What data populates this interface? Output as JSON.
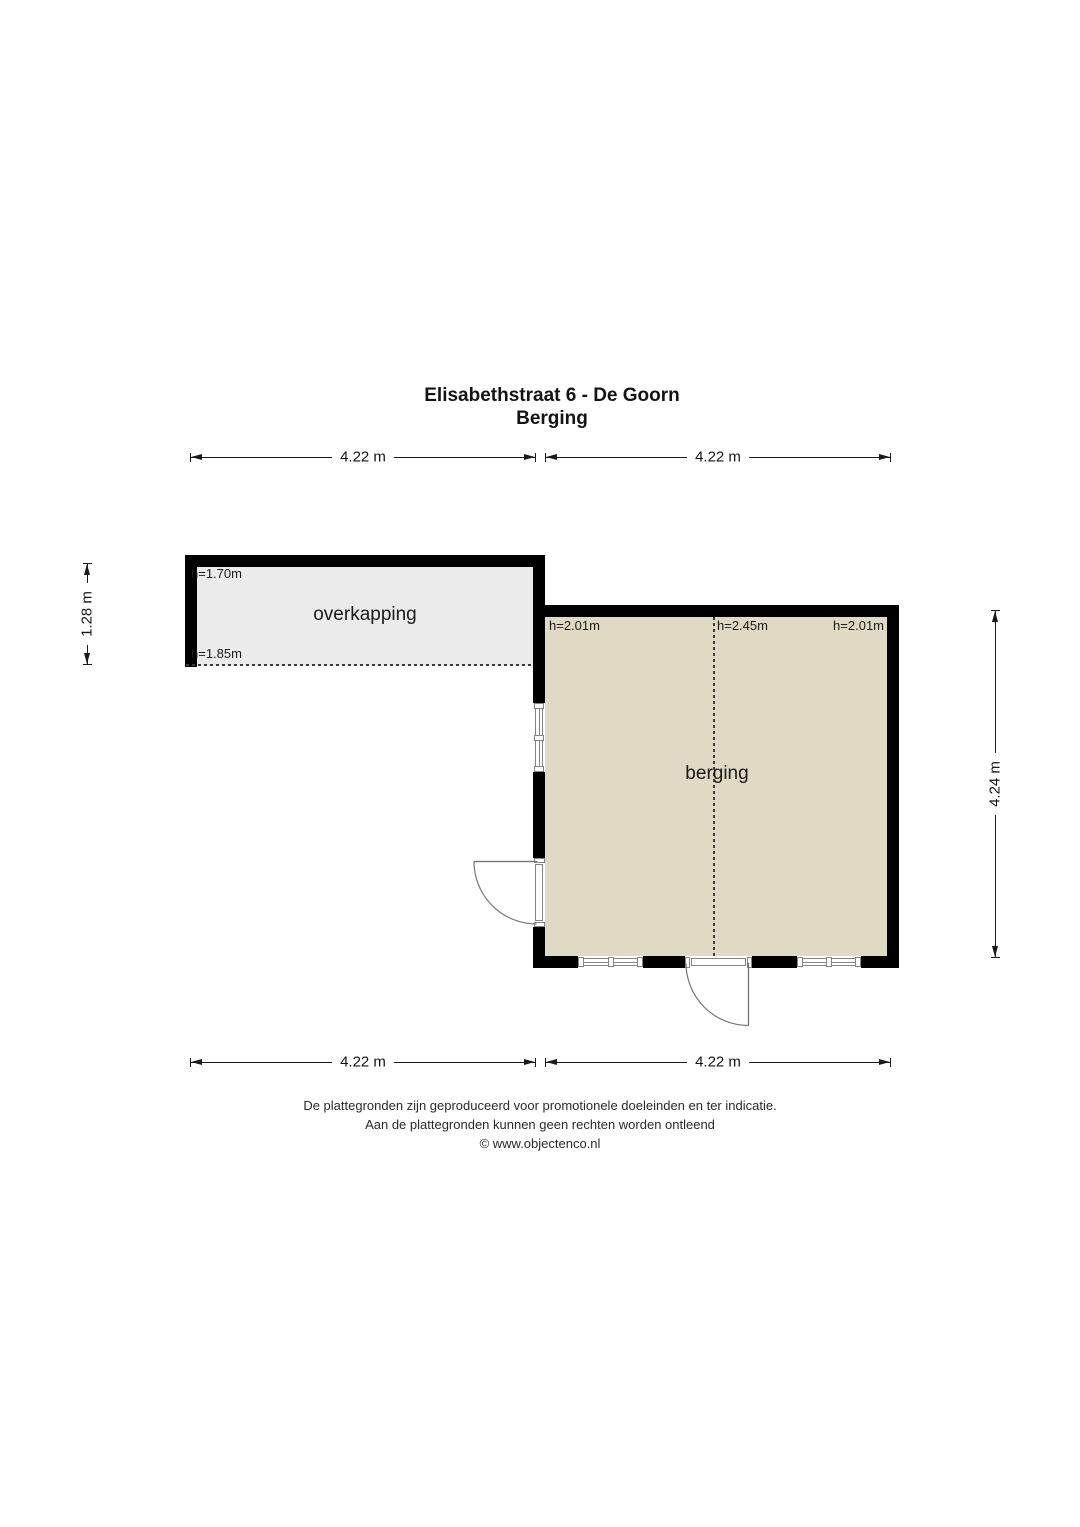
{
  "title": {
    "line1": "Elisabethstraat 6 - De Goorn",
    "line2": "Berging"
  },
  "dimensions": {
    "top_left": "4.22 m",
    "top_right": "4.22 m",
    "bottom_left": "4.22 m",
    "bottom_right": "4.22 m",
    "left": "1.28 m",
    "right": "4.24 m"
  },
  "rooms": {
    "overkapping": {
      "name": "overkapping",
      "height_top": "h=1.70m",
      "height_bottom": "h=1.85m"
    },
    "berging": {
      "name": "berging",
      "height_left": "h=2.01m",
      "height_center": "h=2.45m",
      "height_right": "h=2.01m"
    }
  },
  "footer": {
    "line1": "De plattegronden zijn geproduceerd voor promotionele doeleinden en ter indicatie.",
    "line2": "Aan de plattegronden kunnen geen rechten worden ontleend",
    "line3": "© www.objectenco.nl"
  },
  "colors": {
    "wall": "#000000",
    "berging_fill": "#e0d9c3",
    "overkapping_fill": "#ebebeb",
    "line": "#1a1a1a",
    "window_line": "#848484",
    "door_line": "#787878"
  }
}
